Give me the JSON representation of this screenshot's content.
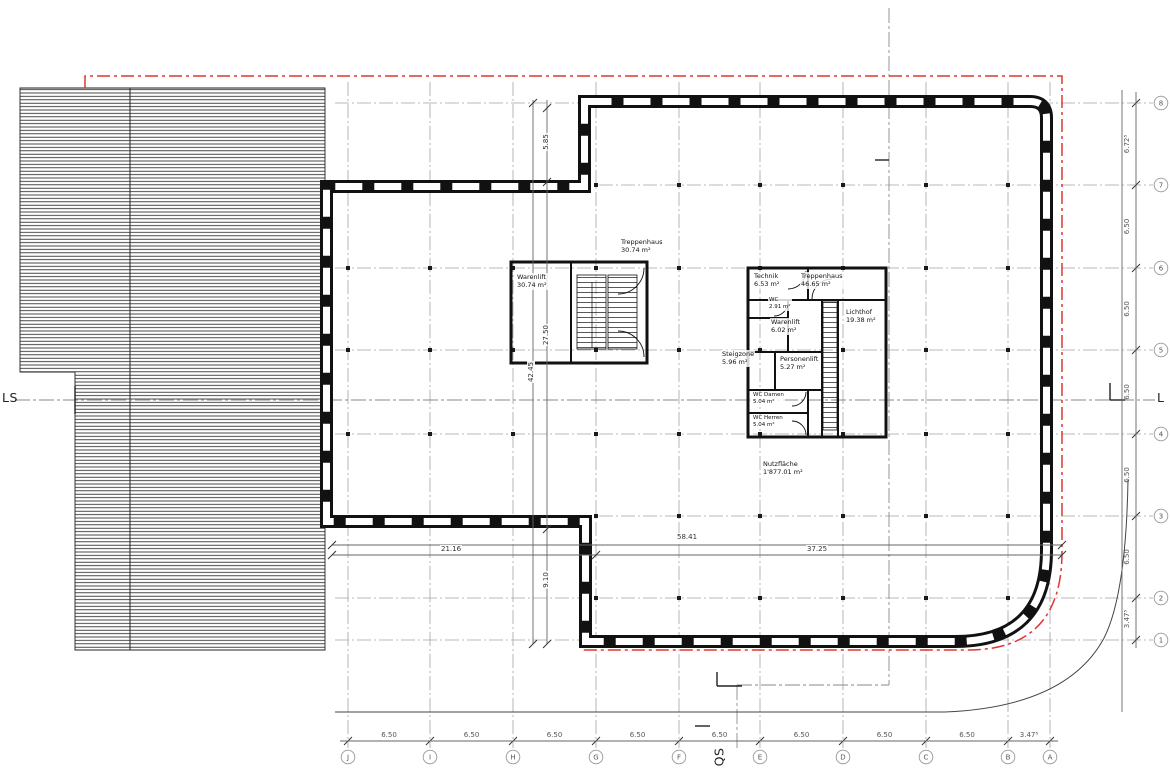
{
  "axes": {
    "letters": [
      "J",
      "I",
      "H",
      "G",
      "F",
      "E",
      "D",
      "C",
      "B",
      "A"
    ],
    "numbers": [
      "8",
      "7",
      "6",
      "5",
      "4",
      "3",
      "2",
      "1"
    ]
  },
  "dims": {
    "bottom": [
      "6.50",
      "6.50",
      "6.50",
      "6.50",
      "6.50",
      "6.50",
      "6.50",
      "6.50",
      "3.47⁵"
    ],
    "right": [
      "6.72⁵",
      "6.50",
      "6.50",
      "6.50",
      "6.50",
      "6.50",
      "3.47⁵"
    ],
    "width_total": "58.41",
    "width_left": "21.16",
    "width_right": "37.25",
    "height_total": "42.45",
    "height_top": "5.85",
    "height_mid": "27.50",
    "height_bottom": "9.10"
  },
  "rooms": {
    "treppenhaus_west": {
      "name": "Treppenhaus",
      "area": "30.74 m²"
    },
    "warenlift_west": {
      "name": "Warenlift",
      "area": "30.74 m²"
    },
    "technik": {
      "name": "Technik",
      "area": "6.53 m²"
    },
    "treppenhaus_ost": {
      "name": "Treppenhaus",
      "area": "46.65 m²"
    },
    "wc": {
      "name": "WC",
      "area": "2.91 m²"
    },
    "warenlift_ost": {
      "name": "Warenlift",
      "area": "6.02 m²"
    },
    "lichthof": {
      "name": "Lichthof",
      "area": "19.38 m²"
    },
    "steigzone": {
      "name": "Steigzone",
      "area": "5.96 m²"
    },
    "personenlift": {
      "name": "Personenlift",
      "area": "5.27 m²"
    },
    "wc_damen": {
      "name": "WC Damen",
      "area": "5.04 m²"
    },
    "wc_herren": {
      "name": "WC Herren",
      "area": "5.04 m²"
    },
    "nutzflaeche": {
      "name": "Nutzfläche",
      "area": "1'877.01 m²"
    }
  },
  "sections": {
    "ls": "LS",
    "l": "L",
    "qs": "QS"
  },
  "colors": {
    "wall": "#111111",
    "boundary_red": "#e0362f",
    "grid": "#9a9a9a",
    "dim": "#555555"
  }
}
